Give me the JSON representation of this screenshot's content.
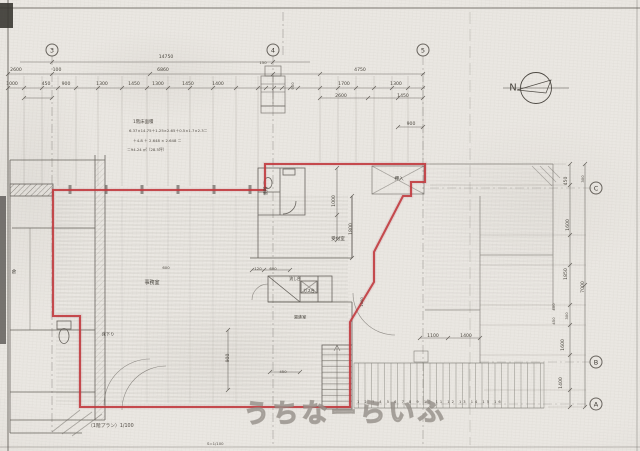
{
  "title": "scanned 1F architectural floor plan with red unit outline",
  "colors": {
    "paper": "#eae7e2",
    "ink": "#55514b",
    "red_outline": "#c23a3e",
    "watermark_gray": "#8a857e"
  },
  "watermark": {
    "text": "うちなーらいふ"
  },
  "north_label": "N",
  "grid_bubbles": [
    {
      "t": "3",
      "x": 52,
      "y": 50
    },
    {
      "t": "4",
      "x": 273,
      "y": 50
    },
    {
      "t": "5",
      "x": 423,
      "y": 50
    },
    {
      "t": "C",
      "x": 596,
      "y": 188
    },
    {
      "t": "B",
      "x": 596,
      "y": 362
    },
    {
      "t": "A",
      "x": 596,
      "y": 404
    }
  ],
  "dimensions": [
    {
      "t": "14750",
      "x": 166,
      "y": 57
    },
    {
      "t": "2600",
      "x": 16,
      "y": 70
    },
    {
      "t": "100",
      "x": 57,
      "y": 70
    },
    {
      "t": "6860",
      "x": 163,
      "y": 70
    },
    {
      "t": "4750",
      "x": 360,
      "y": 70
    },
    {
      "t": "150",
      "x": 263,
      "y": 63,
      "fs": 3.8
    },
    {
      "t": "1000",
      "x": 12,
      "y": 84
    },
    {
      "t": "450",
      "x": 46,
      "y": 84
    },
    {
      "t": "900",
      "x": 66,
      "y": 84
    },
    {
      "t": "1300",
      "x": 102,
      "y": 84
    },
    {
      "t": "1450",
      "x": 134,
      "y": 84
    },
    {
      "t": "1300",
      "x": 158,
      "y": 84
    },
    {
      "t": "1450",
      "x": 188,
      "y": 84
    },
    {
      "t": "1400",
      "x": 218,
      "y": 84
    },
    {
      "t": "1700",
      "x": 344,
      "y": 84
    },
    {
      "t": "1300",
      "x": 396,
      "y": 84
    },
    {
      "t": "2600",
      "x": 341,
      "y": 96
    },
    {
      "t": "1450",
      "x": 403,
      "y": 96
    },
    {
      "t": "900",
      "x": 411,
      "y": 124
    },
    {
      "t": "900",
      "x": 293,
      "y": 86,
      "rot": -90,
      "fs": 3.8
    },
    {
      "t": "450",
      "x": 566,
      "y": 181,
      "rot": -90
    },
    {
      "t": "300",
      "x": 583,
      "y": 179,
      "rot": -90,
      "fs": 3.8
    },
    {
      "t": "1600",
      "x": 568,
      "y": 225,
      "rot": -90
    },
    {
      "t": "1850",
      "x": 566,
      "y": 274,
      "rot": -90
    },
    {
      "t": "7000",
      "x": 583,
      "y": 287,
      "rot": -90
    },
    {
      "t": "400",
      "x": 554,
      "y": 307,
      "rot": -90,
      "fs": 3.8
    },
    {
      "t": "450",
      "x": 554,
      "y": 321,
      "rot": -90,
      "fs": 3.8
    },
    {
      "t": "300",
      "x": 567,
      "y": 316,
      "rot": -90,
      "fs": 3.8
    },
    {
      "t": "1600",
      "x": 563,
      "y": 345,
      "rot": -90
    },
    {
      "t": "1400",
      "x": 561,
      "y": 383,
      "rot": -90
    },
    {
      "t": "1000",
      "x": 334,
      "y": 201,
      "rot": -90
    },
    {
      "t": "1800",
      "x": 351,
      "y": 229,
      "rot": -90
    },
    {
      "t": "900",
      "x": 228,
      "y": 358,
      "rot": -90
    },
    {
      "t": "1000",
      "x": 362,
      "y": 302,
      "rot": -90,
      "fs": 3.8
    },
    {
      "t": "120",
      "x": 258,
      "y": 269,
      "fs": 3.8
    },
    {
      "t": "600",
      "x": 273,
      "y": 269,
      "fs": 3.8
    },
    {
      "t": "600",
      "x": 166,
      "y": 268,
      "fs": 3.8
    },
    {
      "t": "1100",
      "x": 433,
      "y": 336
    },
    {
      "t": "1400",
      "x": 466,
      "y": 336
    },
    {
      "t": "450",
      "x": 283,
      "y": 372,
      "fs": 3.8
    }
  ],
  "room_labels": [
    {
      "t": "便所",
      "x": 266,
      "y": 191,
      "rot": -90,
      "fs": 4.4
    },
    {
      "t": "押入",
      "x": 399,
      "y": 179,
      "fs": 4.6
    },
    {
      "t": "受付室",
      "x": 338,
      "y": 239,
      "fs": 4.6
    },
    {
      "t": "事務室",
      "x": 152,
      "y": 283,
      "fs": 5
    },
    {
      "t": "流し台",
      "x": 295,
      "y": 279,
      "fs": 3.8
    },
    {
      "t": "ガス台",
      "x": 309,
      "y": 291,
      "fs": 3.8
    },
    {
      "t": "湯沸室",
      "x": 300,
      "y": 317,
      "fs": 4.2
    },
    {
      "t": "床下り",
      "x": 108,
      "y": 334,
      "fs": 4.2
    },
    {
      "t": "倉",
      "x": 14,
      "y": 272,
      "fs": 4.5
    }
  ],
  "notes": [
    {
      "t": "1階床面積",
      "x": 133,
      "y": 122,
      "al": "l",
      "fs": 4.4
    },
    {
      "t": "6.37×14.75＋1.25×2.65＋0.5×1.7×2.3＝",
      "x": 129,
      "y": 131,
      "al": "l",
      "fs": 3.8
    },
    {
      "t": "＋4.8 ＋ 2.648 × 2.648 ＝",
      "x": 133,
      "y": 141,
      "al": "l",
      "fs": 3.8
    },
    {
      "t": "＝94.24 ㎡（28.5坪）",
      "x": 127,
      "y": 150,
      "al": "l",
      "fs": 3.8
    },
    {
      "t": "（1階プラン）1/100",
      "x": 88,
      "y": 426,
      "al": "l",
      "fs": 4.8
    },
    {
      "t": "S=1/100",
      "x": 207,
      "y": 444,
      "al": "l",
      "fs": 3.8
    },
    {
      "t": "1 2 3 4 5 6 7 8 9 10 11 12 13 14 15 16",
      "x": 357,
      "y": 402,
      "al": "l",
      "fs": 3.6,
      "ls": 4
    }
  ]
}
